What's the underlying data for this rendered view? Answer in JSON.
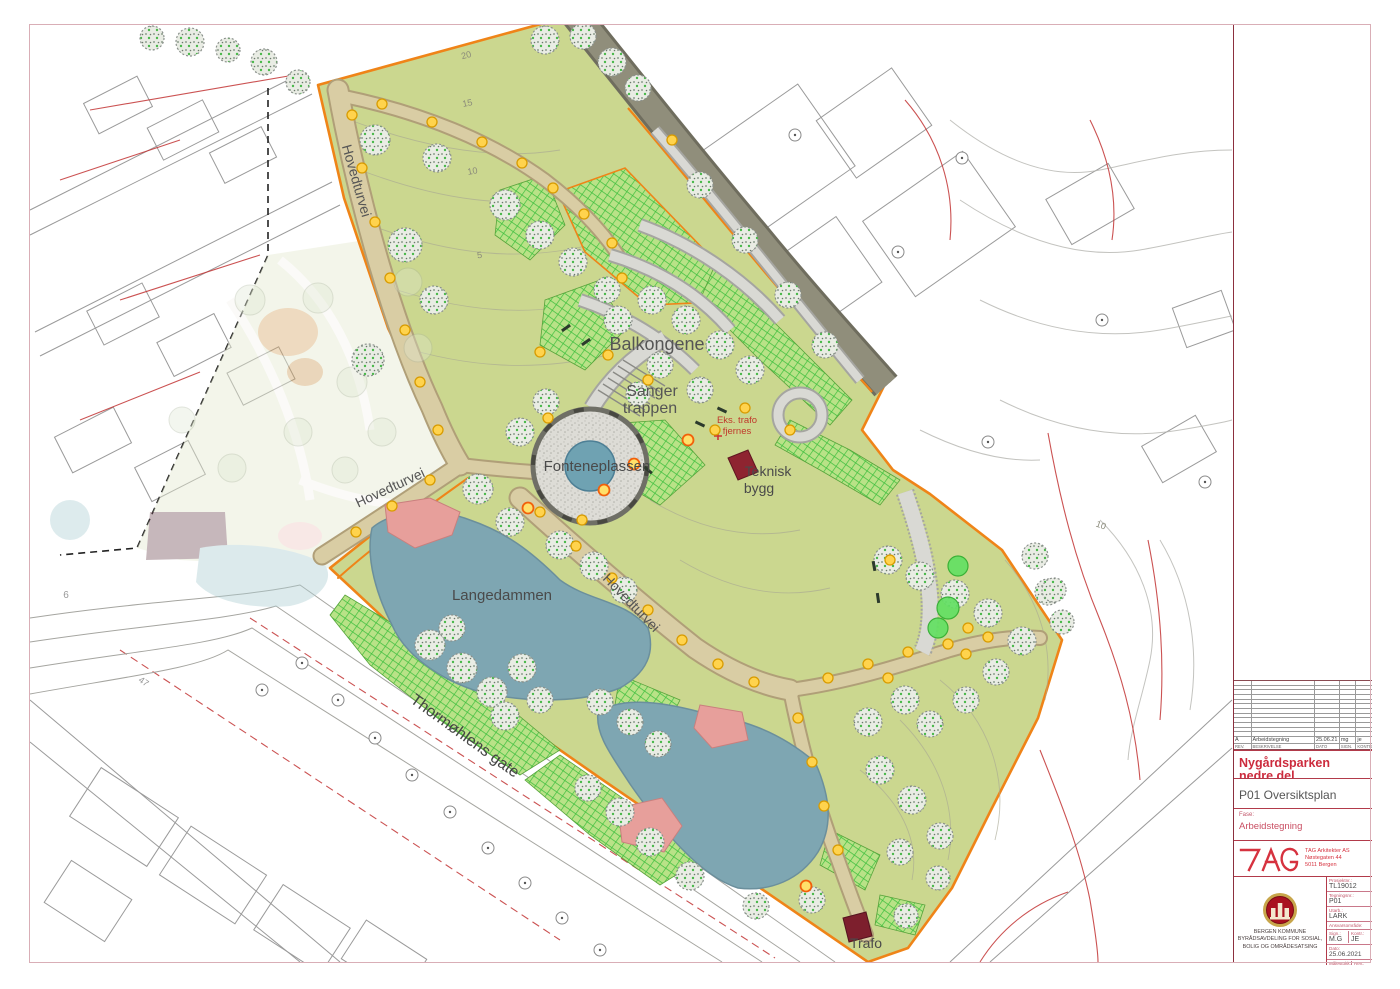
{
  "page": {
    "background": "#ffffff",
    "frame_color": "#d9aeb6"
  },
  "map": {
    "colors": {
      "park_green": "#cbd78f",
      "lake_blue": "#7ea6b2",
      "path_tan": "#d9cda4",
      "road_gray": "#8b8977",
      "boundary_orange": "#ef8418",
      "hatch_green": "#3fbf3f",
      "pink_area": "#e79f9b",
      "building_red": "#8e2430",
      "lamp_yellow": "#ffd34d"
    },
    "labels": [
      {
        "text": "Hovedturvei",
        "x": 352,
        "y": 182,
        "rot": 74,
        "size": 14,
        "color": "#555555"
      },
      {
        "text": "Hovedturvei",
        "x": 392,
        "y": 492,
        "rot": -25,
        "size": 14,
        "color": "#555555"
      },
      {
        "text": "Hovedturvei",
        "x": 628,
        "y": 606,
        "rot": 46,
        "size": 14,
        "color": "#555555"
      },
      {
        "text": "Thormøhlens gate",
        "x": 462,
        "y": 740,
        "rot": 36,
        "size": 16,
        "color": "#444444"
      },
      {
        "text": "Balkongene",
        "x": 657,
        "y": 350,
        "rot": 0,
        "size": 18,
        "color": "#555555"
      },
      {
        "text": "Sanger",
        "x": 652,
        "y": 396,
        "rot": 0,
        "size": 16,
        "color": "#555555"
      },
      {
        "text": "trappen",
        "x": 650,
        "y": 413,
        "rot": 0,
        "size": 16,
        "color": "#555555"
      },
      {
        "text": "Fonteneplassen",
        "x": 597,
        "y": 471,
        "rot": 0,
        "size": 15,
        "color": "#4a4a4a"
      },
      {
        "text": "Langedammen",
        "x": 502,
        "y": 600,
        "rot": 0,
        "size": 15,
        "color": "#4a4a4a"
      },
      {
        "text": "Teknisk",
        "x": 768,
        "y": 476,
        "rot": 0,
        "size": 14,
        "color": "#4a4a4a"
      },
      {
        "text": "bygg",
        "x": 759,
        "y": 493,
        "rot": 0,
        "size": 14,
        "color": "#4a4a4a"
      },
      {
        "text": "Trafo",
        "x": 866,
        "y": 948,
        "rot": 0,
        "size": 14,
        "color": "#4a4a4a"
      },
      {
        "text": "Eks. trafo",
        "x": 737,
        "y": 423,
        "rot": 0,
        "size": 9.5,
        "color": "#c0392b"
      },
      {
        "text": "fjernes",
        "x": 737,
        "y": 434,
        "rot": 0,
        "size": 9.5,
        "color": "#c0392b"
      },
      {
        "text": "20",
        "x": 467,
        "y": 58,
        "rot": -15,
        "size": 9,
        "color": "#8a8a7a"
      },
      {
        "text": "15",
        "x": 468,
        "y": 106,
        "rot": -12,
        "size": 9,
        "color": "#8a8a7a"
      },
      {
        "text": "10",
        "x": 473,
        "y": 174,
        "rot": -10,
        "size": 9,
        "color": "#8a8a7a"
      },
      {
        "text": "5",
        "x": 480,
        "y": 258,
        "rot": -8,
        "size": 9,
        "color": "#8a8a7a"
      },
      {
        "text": "10",
        "x": 1100,
        "y": 528,
        "rot": 20,
        "size": 9,
        "color": "#8a8a7a"
      },
      {
        "text": "6",
        "x": 66,
        "y": 598,
        "rot": 0,
        "size": 10,
        "color": "#999999"
      },
      {
        "text": "47",
        "x": 142,
        "y": 684,
        "rot": 35,
        "size": 9,
        "color": "#999999"
      }
    ],
    "trees_existing": [
      [
        545,
        40,
        14
      ],
      [
        583,
        36,
        13
      ],
      [
        612,
        62,
        14
      ],
      [
        638,
        88,
        13
      ],
      [
        190,
        42,
        14
      ],
      [
        228,
        50,
        12
      ],
      [
        264,
        62,
        13
      ],
      [
        298,
        82,
        12
      ],
      [
        152,
        38,
        12
      ],
      [
        375,
        140,
        15
      ],
      [
        405,
        245,
        17
      ],
      [
        368,
        360,
        16
      ],
      [
        434,
        300,
        14
      ],
      [
        437,
        158,
        14
      ],
      [
        505,
        205,
        15
      ],
      [
        540,
        235,
        14
      ],
      [
        573,
        262,
        14
      ],
      [
        607,
        290,
        13
      ],
      [
        618,
        320,
        14
      ],
      [
        652,
        300,
        14
      ],
      [
        686,
        320,
        14
      ],
      [
        720,
        345,
        14
      ],
      [
        750,
        370,
        14
      ],
      [
        660,
        365,
        13
      ],
      [
        700,
        390,
        13
      ],
      [
        638,
        394,
        12
      ],
      [
        700,
        185,
        13
      ],
      [
        745,
        240,
        13
      ],
      [
        788,
        295,
        13
      ],
      [
        825,
        345,
        13
      ],
      [
        520,
        432,
        14
      ],
      [
        546,
        402,
        13
      ],
      [
        478,
        489,
        15
      ],
      [
        510,
        522,
        14
      ],
      [
        560,
        545,
        14
      ],
      [
        594,
        566,
        14
      ],
      [
        624,
        590,
        13
      ],
      [
        430,
        645,
        15
      ],
      [
        462,
        668,
        15
      ],
      [
        492,
        692,
        15
      ],
      [
        522,
        668,
        14
      ],
      [
        505,
        716,
        14
      ],
      [
        540,
        700,
        13
      ],
      [
        452,
        628,
        13
      ],
      [
        600,
        702,
        13
      ],
      [
        630,
        722,
        13
      ],
      [
        658,
        744,
        13
      ],
      [
        620,
        812,
        14
      ],
      [
        650,
        842,
        14
      ],
      [
        690,
        876,
        14
      ],
      [
        588,
        788,
        13
      ],
      [
        756,
        906,
        13
      ],
      [
        812,
        900,
        13
      ],
      [
        906,
        916,
        12
      ],
      [
        888,
        560,
        14
      ],
      [
        920,
        576,
        14
      ],
      [
        955,
        594,
        14
      ],
      [
        988,
        613,
        14
      ],
      [
        1022,
        641,
        14
      ],
      [
        1048,
        592,
        13
      ],
      [
        905,
        700,
        14
      ],
      [
        868,
        722,
        14
      ],
      [
        930,
        724,
        13
      ],
      [
        966,
        700,
        13
      ],
      [
        996,
        672,
        13
      ],
      [
        880,
        770,
        14
      ],
      [
        912,
        800,
        14
      ],
      [
        940,
        836,
        13
      ],
      [
        900,
        852,
        13
      ],
      [
        938,
        878,
        12
      ],
      [
        1035,
        556,
        13
      ],
      [
        1054,
        590,
        12
      ],
      [
        1062,
        622,
        12
      ]
    ],
    "trees_new_green": [
      [
        948,
        608,
        11
      ],
      [
        938,
        628,
        10
      ],
      [
        958,
        566,
        10
      ]
    ],
    "trees_faded": [
      [
        250,
        300,
        15
      ],
      [
        318,
        298,
        15
      ],
      [
        352,
        382,
        15
      ],
      [
        298,
        432,
        14
      ],
      [
        232,
        468,
        14
      ],
      [
        382,
        432,
        14
      ],
      [
        418,
        348,
        14
      ],
      [
        182,
        420,
        13
      ],
      [
        408,
        282,
        14
      ],
      [
        345,
        470,
        13
      ]
    ],
    "street_trees": [
      [
        302,
        663
      ],
      [
        338,
        700
      ],
      [
        375,
        738
      ],
      [
        412,
        775
      ],
      [
        450,
        812
      ],
      [
        488,
        848
      ],
      [
        525,
        883
      ],
      [
        562,
        918
      ],
      [
        600,
        950
      ],
      [
        262,
        690
      ],
      [
        795,
        135
      ],
      [
        962,
        158
      ],
      [
        898,
        252
      ],
      [
        988,
        442
      ],
      [
        1205,
        482
      ],
      [
        1102,
        320
      ]
    ],
    "lamps_yellow": [
      [
        352,
        115
      ],
      [
        362,
        168
      ],
      [
        375,
        222
      ],
      [
        390,
        278
      ],
      [
        405,
        330
      ],
      [
        420,
        382
      ],
      [
        438,
        430
      ],
      [
        430,
        480
      ],
      [
        392,
        506
      ],
      [
        356,
        532
      ],
      [
        382,
        104
      ],
      [
        432,
        122
      ],
      [
        482,
        142
      ],
      [
        522,
        163
      ],
      [
        553,
        188
      ],
      [
        584,
        214
      ],
      [
        612,
        243
      ],
      [
        672,
        140
      ],
      [
        622,
        278
      ],
      [
        648,
        380
      ],
      [
        608,
        355
      ],
      [
        540,
        352
      ],
      [
        548,
        418
      ],
      [
        582,
        520
      ],
      [
        540,
        512
      ],
      [
        576,
        546
      ],
      [
        612,
        578
      ],
      [
        648,
        610
      ],
      [
        682,
        640
      ],
      [
        718,
        664
      ],
      [
        754,
        682
      ],
      [
        828,
        678
      ],
      [
        868,
        664
      ],
      [
        908,
        652
      ],
      [
        948,
        644
      ],
      [
        988,
        637
      ],
      [
        798,
        718
      ],
      [
        812,
        762
      ],
      [
        824,
        806
      ],
      [
        838,
        850
      ],
      [
        890,
        560
      ],
      [
        968,
        628
      ],
      [
        966,
        654
      ],
      [
        888,
        678
      ],
      [
        715,
        430
      ],
      [
        745,
        408
      ],
      [
        790,
        430
      ]
    ],
    "lamps_orange_ring": [
      [
        806,
        886
      ],
      [
        688,
        440
      ],
      [
        634,
        464
      ],
      [
        528,
        508
      ],
      [
        604,
        490
      ]
    ],
    "benches": [
      [
        566,
        328,
        -35
      ],
      [
        586,
        342,
        -35
      ],
      [
        700,
        424,
        25
      ],
      [
        722,
        410,
        25
      ],
      [
        648,
        470,
        40
      ],
      [
        874,
        566,
        80
      ],
      [
        878,
        598,
        82
      ]
    ]
  },
  "title_block": {
    "revision_table": {
      "empty_row_count": 12,
      "filled_row": {
        "rev": "A",
        "description": "Arbeidstegning",
        "date": "25.06.21",
        "sign": "mg",
        "kontr": "je"
      },
      "header_row": {
        "rev": "REV.",
        "description": "BESKRIVELSE",
        "date": "DATO",
        "sign": "SIGN.",
        "kontr": "KONTR."
      }
    },
    "project_title": "Nygårdsparken nedre del",
    "drawing_title": "P01 Oversiktsplan",
    "phase_label": "Fase:",
    "phase_value": "Arbeidstegning",
    "architect": {
      "name": "TAG Arkitekter AS",
      "address_line1": "Nøstegaten 44",
      "address_line2": "5011 Bergen"
    },
    "fields": {
      "prosjektnr_label": "Prosjektnr.:",
      "prosjektnr": "TL19012",
      "tegningsnr_label": "Tegningsnr.:",
      "tegningsnr": "P01",
      "utarb_label": "Utarb.:",
      "utarb": "LARK",
      "ansvar_label": "Ansvarsområde:",
      "sign_label": "Sign.:",
      "sign": "M.G",
      "kontr_label": "Kontr.:",
      "kontr": "JE",
      "dato_label": "Dato:",
      "dato": "25.06.2021",
      "malestokk_label": "Målestokk:",
      "malestokk": "1:500 (A1)",
      "rev_label": "Rev.:",
      "rev": "A"
    },
    "client": {
      "line1": "BERGEN KOMMUNE",
      "line2": "BYRÅDSAVDELING FOR SOSIAL,",
      "line3": "BOLIG OG OMRÅDESATSING"
    }
  }
}
